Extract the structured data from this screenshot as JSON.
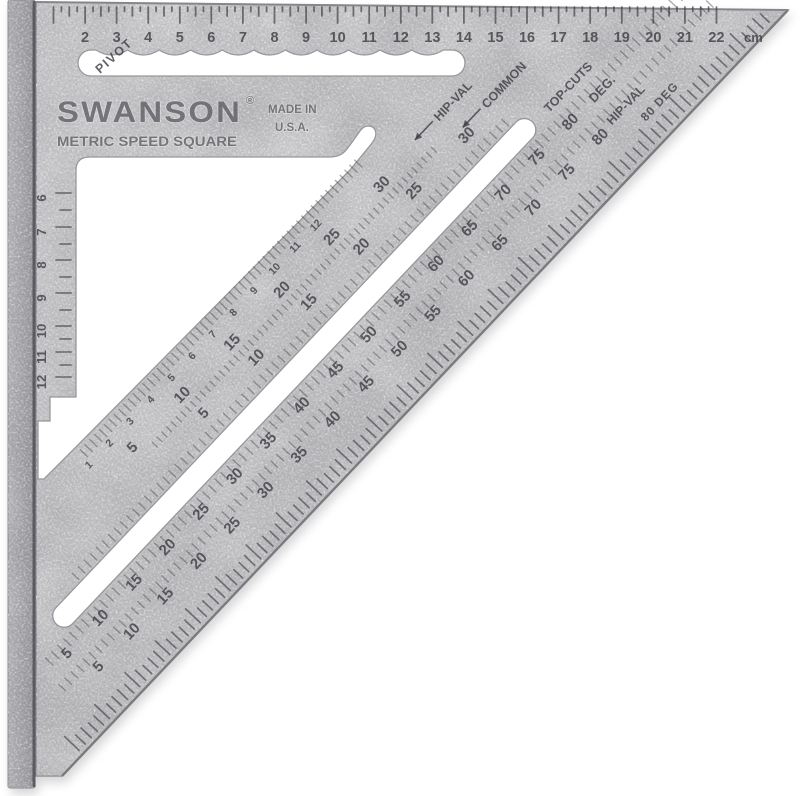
{
  "product": {
    "brand": "SWANSON",
    "registered_mark": "®",
    "made_line1": "MADE IN",
    "made_line2": "U.S.A.",
    "name": "METRIC SPEED SQUARE",
    "pivot_label": "PIVOT"
  },
  "top_ruler": {
    "numbers": [
      2,
      3,
      4,
      5,
      6,
      7,
      8,
      9,
      10,
      11,
      12,
      13,
      14,
      15,
      16,
      17,
      18,
      19,
      20,
      21,
      22
    ],
    "unit_label": "cm"
  },
  "left_ruler": {
    "numbers": [
      6,
      7,
      8,
      9,
      10,
      11,
      12
    ]
  },
  "scales": {
    "edge_caption": "80 DEG",
    "top_cuts_label": "TOP-CUTS",
    "deg": {
      "label": "DEG.",
      "values": [
        5,
        10,
        15,
        20,
        25,
        30,
        35,
        40,
        45,
        50,
        55,
        60,
        65,
        70,
        75,
        80
      ]
    },
    "outer_hip_val": {
      "label": "HIP-VAL",
      "values": [
        5,
        10,
        15,
        20,
        25,
        30,
        35,
        40,
        45,
        50,
        55,
        60,
        65,
        70,
        75,
        80
      ]
    },
    "common": {
      "label": "COMMON",
      "arrow_icon": "left-arrow",
      "values": [
        5,
        10,
        15,
        20,
        25,
        30
      ]
    },
    "inner_hip_val": {
      "label": "HIP-VAL",
      "arrow_icon": "left-arrow",
      "values": [
        5,
        10,
        15,
        20,
        25,
        30
      ]
    },
    "fine": {
      "values": [
        1,
        2,
        3,
        4,
        5,
        6,
        7,
        8,
        9,
        10,
        11,
        12
      ]
    }
  },
  "colors": {
    "metal_body": "#c9c9cb",
    "metal_dark": "#a8a8ac",
    "engraving": "#3f3f46",
    "edge": "#8b8b90",
    "background": "#ffffff"
  }
}
